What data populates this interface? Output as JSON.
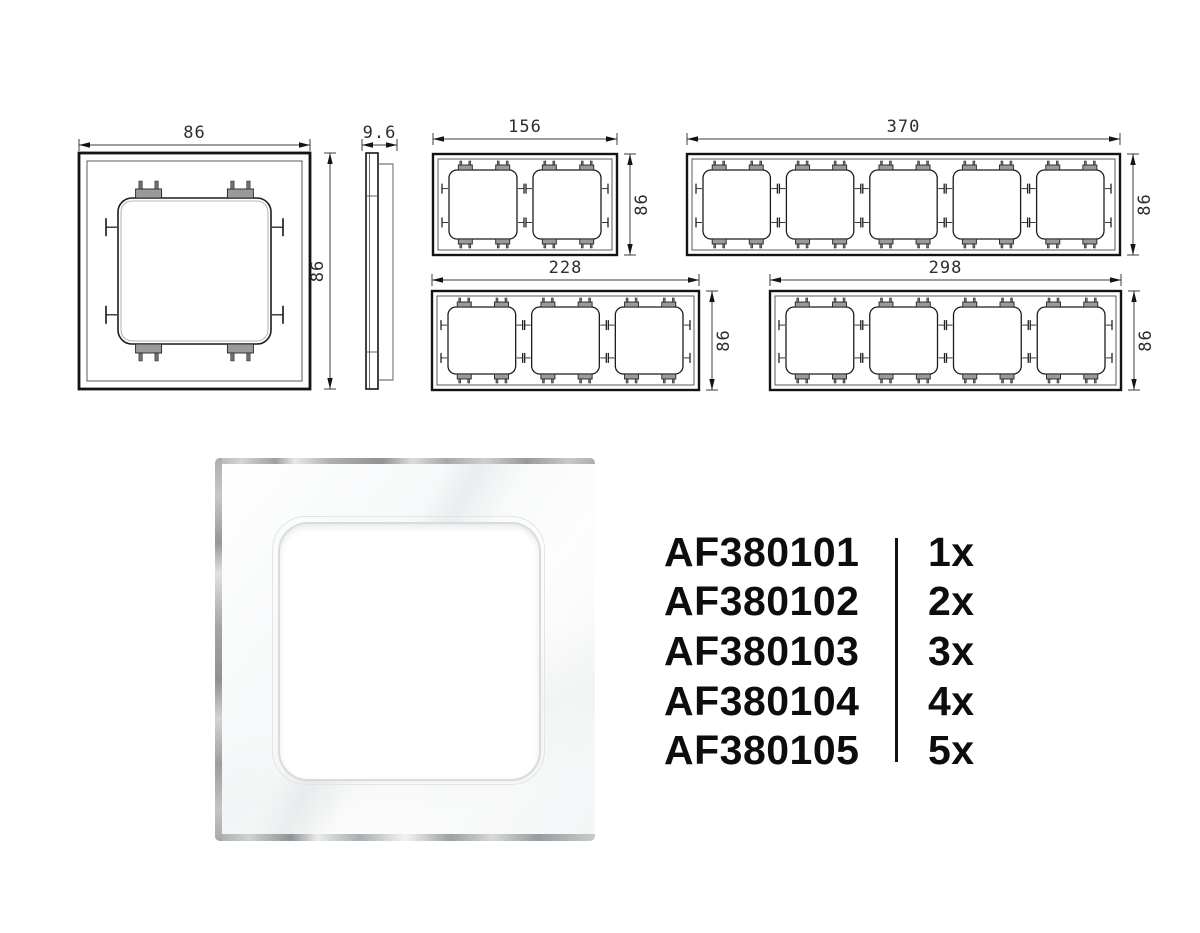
{
  "drawings": [
    {
      "name": "frame-1gang-front",
      "gangs": 1,
      "width_label": "86",
      "height_label": "86"
    },
    {
      "name": "frame-side-profile",
      "gangs": 1,
      "width_label": "9.6",
      "height_label": ""
    },
    {
      "name": "frame-2gang-front",
      "gangs": 2,
      "width_label": "156",
      "height_label": "86"
    },
    {
      "name": "frame-5gang-front",
      "gangs": 5,
      "width_label": "370",
      "height_label": "86"
    },
    {
      "name": "frame-3gang-front",
      "gangs": 3,
      "width_label": "228",
      "height_label": "86"
    },
    {
      "name": "frame-4gang-front",
      "gangs": 4,
      "width_label": "298",
      "height_label": "86"
    }
  ],
  "products": [
    {
      "code": "AF380101",
      "qty": "1x"
    },
    {
      "code": "AF380102",
      "qty": "2x"
    },
    {
      "code": "AF380103",
      "qty": "3x"
    },
    {
      "code": "AF380104",
      "qty": "4x"
    },
    {
      "code": "AF380105",
      "qty": "5x"
    }
  ],
  "colors": {
    "line": "#141414",
    "dim_text": "#2d2d2d",
    "list_text": "#0d0d0d",
    "divider": "#121212",
    "glass_edge": "#a8acae"
  }
}
